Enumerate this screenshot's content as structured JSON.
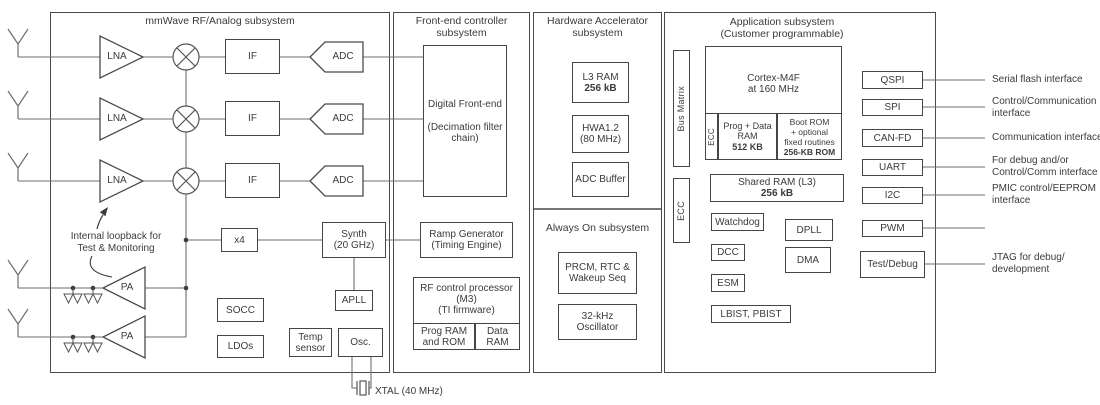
{
  "colors": {
    "background": "#ffffff",
    "box_border": "#454545",
    "section_border": "#4a4a4a",
    "connector_line": "#6e6e6e",
    "text": "#3b3b3b"
  },
  "sections": {
    "mmwave": {
      "title": "mmWave RF/Analog subsystem"
    },
    "frontend": {
      "title1": "Front-end controller",
      "title2": "subsystem"
    },
    "hwa": {
      "title1": "Hardware Accelerator",
      "title2": "subsystem"
    },
    "alwayson": {
      "title": "Always On subsystem"
    },
    "app": {
      "title1": "Application subsystem",
      "title2": "(Customer programmable)"
    }
  },
  "mmwave": {
    "lna": "LNA",
    "if": "IF",
    "adc": "ADC",
    "pa": "PA",
    "x4": "x4",
    "synth1": "Synth",
    "synth2": "(20 GHz)",
    "apll": "APLL",
    "socc": "SOCC",
    "ldos": "LDOs",
    "temp1": "Temp",
    "temp2": "sensor",
    "osc": "Osc.",
    "loopback1": "Internal loopback for",
    "loopback2": "Test & Monitoring",
    "xtal": "XTAL (40 MHz)"
  },
  "frontend": {
    "dfe1": "Digital Front-end",
    "dfe2": "(Decimation filter",
    "dfe3": "chain)",
    "ramp1": "Ramp Generator",
    "ramp2": "(Timing Engine)",
    "rfproc1": "RF control processor",
    "rfproc2": "(M3)",
    "rfproc3": "(TI firmware)",
    "progrom1": "Prog RAM",
    "progrom2": "and ROM",
    "dataram1": "Data",
    "dataram2": "RAM"
  },
  "hwa": {
    "l31": "L3 RAM",
    "l32": "256 kB",
    "hwa1": "HWA1.2",
    "hwa2": "(80 MHz)",
    "adcbuf": "ADC Buffer"
  },
  "alwayson": {
    "prcm1": "PRCM, RTC &",
    "prcm2": "Wakeup Seq",
    "osc1": "32-kHz",
    "osc2": "Oscillator"
  },
  "app": {
    "busmatrix": "Bus Matrix",
    "ecc": "ECC",
    "cortex1": "Cortex-M4F",
    "cortex2": "at 160 MHz",
    "ecc2": "ECC",
    "pd1": "Prog + Data",
    "pd2": "RAM",
    "pd3": "512 KB",
    "br1": "Boot ROM",
    "br2": "+ optional",
    "br3": "fixed routines",
    "br4": "256-KB ROM",
    "shared1": "Shared RAM (L3)",
    "shared2": "256 kB",
    "watchdog": "Watchdog",
    "dpll": "DPLL",
    "dcc": "DCC",
    "dma": "DMA",
    "esm": "ESM",
    "lbist": "LBIST, PBIST"
  },
  "interfaces": [
    {
      "label": "QSPI",
      "desc": [
        "Serial flash interface",
        ""
      ]
    },
    {
      "label": "SPI",
      "desc": [
        "Control/Communication",
        "interface"
      ]
    },
    {
      "label": "CAN-FD",
      "desc": [
        "Communication interface",
        ""
      ]
    },
    {
      "label": "UART",
      "desc": [
        "For debug and/or",
        "Control/Comm interface"
      ]
    },
    {
      "label": "I2C",
      "desc": [
        "PMIC control/EEPROM",
        "interface"
      ]
    },
    {
      "label": "PWM",
      "desc": [
        "",
        ""
      ]
    },
    {
      "label": "Test/Debug",
      "desc": [
        "JTAG for debug/",
        "development"
      ]
    }
  ]
}
